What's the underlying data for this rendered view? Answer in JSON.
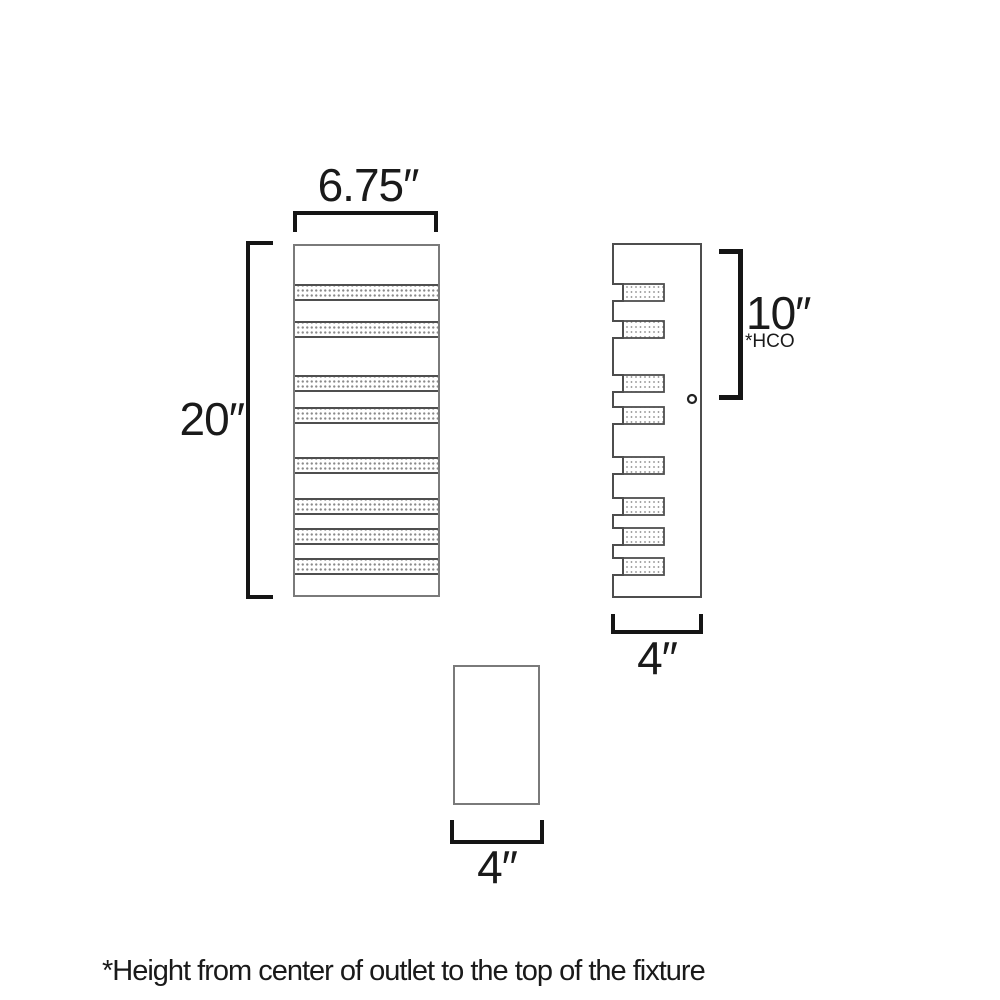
{
  "page": {
    "background": "#ffffff"
  },
  "colors": {
    "dimension_lines": "#151515",
    "text": "#1a1a1a",
    "side_outline": "#4d4d4d",
    "panel_outline": "#7a7a7a",
    "band_border": "#4f4f4f",
    "stipple_dot": "#8a8a8a"
  },
  "labels": {
    "front_width": "6.75″",
    "front_height": "20″",
    "side_hco": "10″",
    "side_hco_note": "*HCO",
    "side_depth": "4″",
    "bottom_width": "4″",
    "footnote": "*Height from center of outlet to the top of the fixture"
  },
  "fixture": {
    "band_count": 8,
    "band_tops_px": [
      284,
      321,
      375,
      407,
      457,
      498,
      528,
      558
    ],
    "band_height_px": 17,
    "geometry": {
      "front": {
        "x": 293,
        "y": 244,
        "w": 147,
        "h": 353,
        "border": 2
      },
      "side": {
        "outer": 613,
        "floor": 623,
        "right": 701,
        "top": 244,
        "bottom": 597,
        "band_w": 41
      },
      "screw": {
        "cx": 692,
        "cy": 399,
        "r": 4
      },
      "bottom_view": {
        "x": 453,
        "y": 665,
        "w": 87,
        "h": 140
      }
    }
  }
}
